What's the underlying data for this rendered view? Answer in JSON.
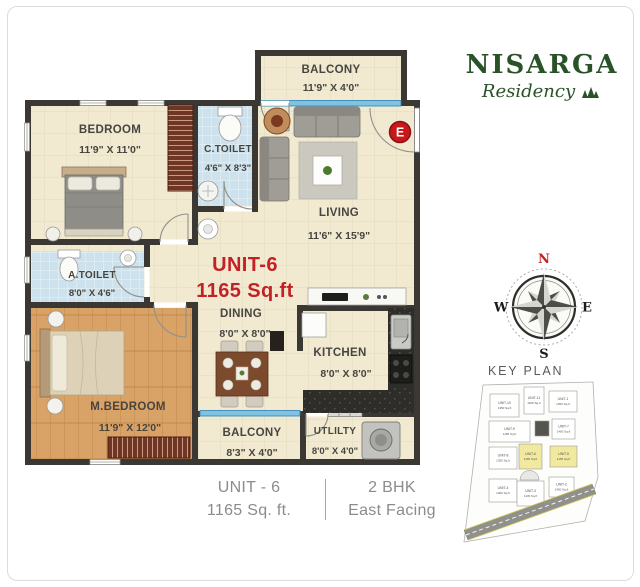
{
  "brand": {
    "name": "NISARGA",
    "tagline": "Residency"
  },
  "plan": {
    "unit_label": "UNIT-6",
    "unit_area": "1165 Sq.ft",
    "entry_marker": "E",
    "rooms": {
      "balcony_top": {
        "name": "BALCONY",
        "dims": "11'9\" X 4'0\""
      },
      "bedroom": {
        "name": "BEDROOM",
        "dims": "11'9\" X 11'0\""
      },
      "c_toilet": {
        "name": "C.TOILET",
        "dims": "4'6\" X 8'3\""
      },
      "living": {
        "name": "LIVING",
        "dims": "11'6\" X 15'9\""
      },
      "a_toilet": {
        "name": "A.TOILET",
        "dims": "8'0\" X 4'6\""
      },
      "m_bedroom": {
        "name": "M.BEDROOM",
        "dims": "11'9\" X 12'0\""
      },
      "dining": {
        "name": "DINING",
        "dims": "8'0\" X 8'0\""
      },
      "kitchen": {
        "name": "KITCHEN",
        "dims": "8'0\" X 8'0\""
      },
      "balcony_bottom": {
        "name": "BALCONY",
        "dims": "8'3\" X 4'0\""
      },
      "utility": {
        "name": "UTLILTY",
        "dims": "8'0\" X 4'0\""
      }
    }
  },
  "compass": {
    "north": "N",
    "south": "S",
    "east": "E",
    "west": "W"
  },
  "key_plan": {
    "title": "KEY PLAN",
    "units": [
      {
        "label": "UNIT-10",
        "area": "1350 Sq.ft",
        "highlight": false
      },
      {
        "label": "UNIT-11",
        "area": "1165 Sq.ft",
        "highlight": false
      },
      {
        "label": "UNIT-1",
        "area": "1350 Sq.ft",
        "highlight": false
      },
      {
        "label": "UNIT-9",
        "area": "1165 Sq.ft",
        "highlight": false
      },
      {
        "label": "UNIT-7",
        "area": "1400 Sq.ft",
        "highlight": false
      },
      {
        "label": "UNIT-8",
        "area": "1350 Sq.ft",
        "highlight": false
      },
      {
        "label": "UNIT-6",
        "area": "1165 Sq.ft",
        "highlight": true
      },
      {
        "label": "UNIT-5",
        "area": "1165 Sq.ft",
        "highlight": true
      },
      {
        "label": "UNIT-4",
        "area": "1400 Sq.ft",
        "highlight": false
      },
      {
        "label": "UNIT-3",
        "area": "1145 Sq.ft",
        "highlight": false
      },
      {
        "label": "UNIT-2",
        "area": "1400 Sq.ft",
        "highlight": false
      }
    ]
  },
  "caption": {
    "unit": "UNIT - 6",
    "type": "2 BHK",
    "area": "1165 Sq. ft.",
    "facing": "East Facing"
  },
  "colors": {
    "accent_red": "#c42127",
    "brand_green": "#2a5229",
    "wall": "#3b3733",
    "floor_cream": "#f1ead1",
    "floor_wood": "#d9a266",
    "tile_blue": "#cde2ec",
    "highlight_yellow": "#f2e9a0",
    "window_blue": "#7ec3e4"
  }
}
